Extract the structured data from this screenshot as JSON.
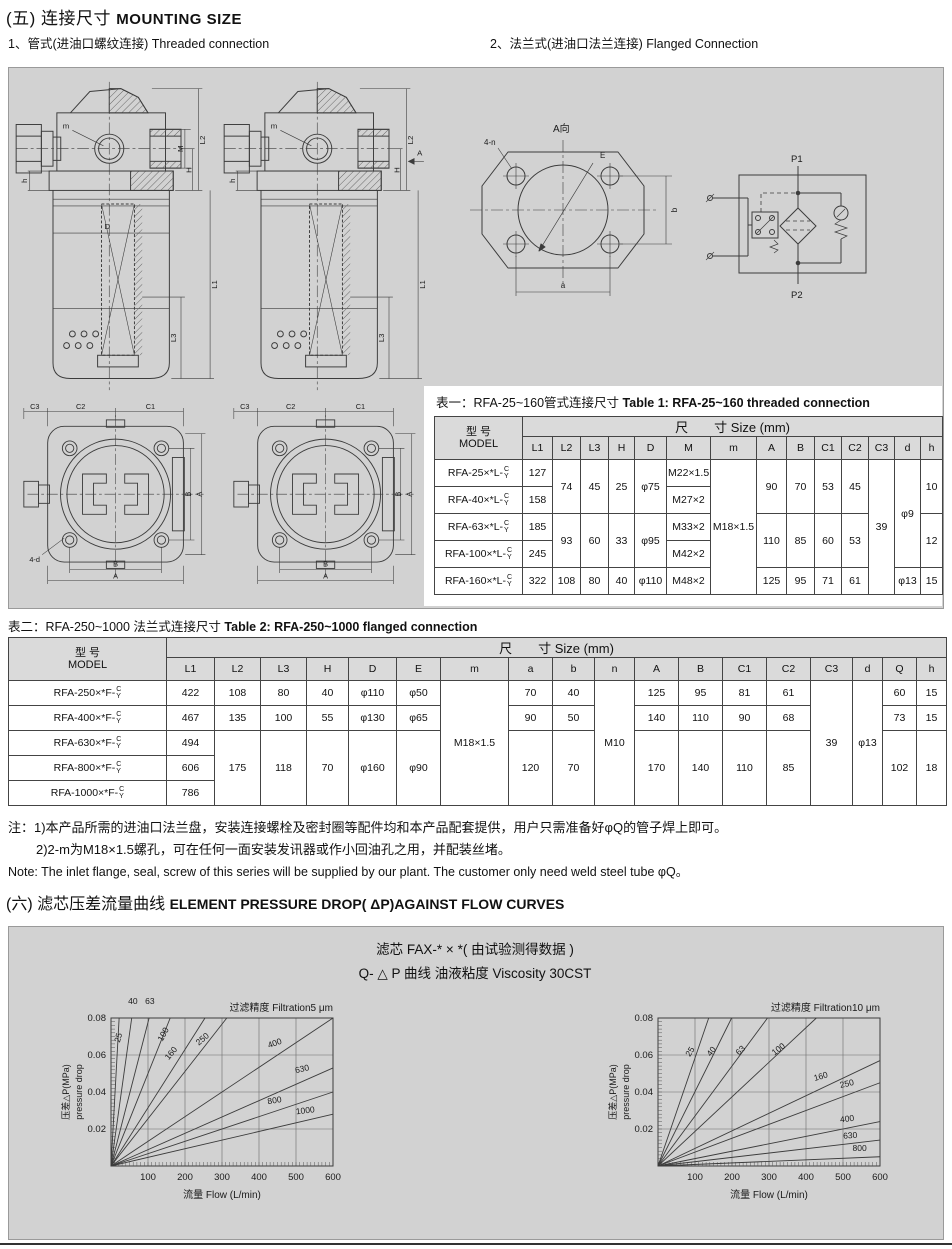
{
  "colors": {
    "panel_bg": "#d2d2d2",
    "line": "#3c3c3c",
    "table_header_bg": "#dadada",
    "text": "#111111"
  },
  "section5": {
    "title_zh": "(五) 连接尺寸",
    "title_en": "MOUNTING SIZE",
    "sub1_zh": "1、管式(进油口螺纹连接)",
    "sub1_en": "Threaded connection",
    "sub2_zh": "2、法兰式(进油口法兰连接)",
    "sub2_en": "Flanged Connection"
  },
  "drawings": {
    "filter1": {
      "m": "m",
      "h": "h",
      "D": "D",
      "M": "M",
      "H": "H",
      "L1": "L1",
      "L2": "L2",
      "L3": "L3"
    },
    "filter2": {
      "m": "m",
      "h": "h",
      "H": "H",
      "L1": "L1",
      "L2": "L2",
      "L3": "L3",
      "A": "A"
    },
    "flange": {
      "view": "A向",
      "bolt": "4-n",
      "E": "E",
      "a": "a",
      "b": "b"
    },
    "topview1": {
      "C1": "C1",
      "C2": "C2",
      "C3": "C3",
      "A": "A",
      "B": "B",
      "A2": "A",
      "B2": "B",
      "bolt": "4-d"
    },
    "topview2": {
      "C1": "C1",
      "C2": "C2",
      "C3": "C3",
      "A": "A",
      "B": "B",
      "A2": "A",
      "B2": "B"
    },
    "symbol": {
      "p1": "P1",
      "p2": "P2"
    }
  },
  "table1": {
    "title_zh": "表一：RFA-25~160管式连接尺寸",
    "title_en": "Table 1: RFA-25~160 threaded connection",
    "model_zh": "型  号",
    "model_en": "MODEL",
    "size_header": "尺　　寸  Size  (mm)",
    "stack": [
      "C",
      "Y"
    ],
    "columns": [
      "L1",
      "L2",
      "L3",
      "H",
      "D",
      "M",
      "m",
      "A",
      "B",
      "C1",
      "C2",
      "C3",
      "d",
      "h"
    ],
    "grid": [
      [
        {
          "m": "RFA-25×*L-"
        },
        {
          "t": "127"
        },
        {
          "t": "74",
          "rs": 2
        },
        {
          "t": "45",
          "rs": 2
        },
        {
          "t": "25",
          "rs": 2
        },
        {
          "t": "φ75",
          "rs": 2
        },
        {
          "t": "M22×1.5"
        },
        {
          "t": "M18×1.5",
          "rs": 5
        },
        {
          "t": "90",
          "rs": 2
        },
        {
          "t": "70",
          "rs": 2
        },
        {
          "t": "53",
          "rs": 2
        },
        {
          "t": "45",
          "rs": 2
        },
        {
          "t": "39",
          "rs": 5
        },
        {
          "t": "φ9",
          "rs": 4
        },
        {
          "t": "10",
          "rs": 2
        }
      ],
      [
        {
          "m": "RFA-40×*L-"
        },
        {
          "t": "158"
        },
        {
          "t": "M27×2"
        }
      ],
      [
        {
          "m": "RFA-63×*L-"
        },
        {
          "t": "185"
        },
        {
          "t": "93",
          "rs": 2
        },
        {
          "t": "60",
          "rs": 2
        },
        {
          "t": "33",
          "rs": 2
        },
        {
          "t": "φ95",
          "rs": 2
        },
        {
          "t": "M33×2"
        },
        {
          "t": "110",
          "rs": 2
        },
        {
          "t": "85",
          "rs": 2
        },
        {
          "t": "60",
          "rs": 2
        },
        {
          "t": "53",
          "rs": 2
        },
        {
          "t": "12",
          "rs": 2
        }
      ],
      [
        {
          "m": "RFA-100×*L-"
        },
        {
          "t": "245"
        },
        {
          "t": "M42×2"
        }
      ],
      [
        {
          "m": "RFA-160×*L-"
        },
        {
          "t": "322"
        },
        {
          "t": "108"
        },
        {
          "t": "80"
        },
        {
          "t": "40"
        },
        {
          "t": "φ110"
        },
        {
          "t": "M48×2"
        },
        {
          "t": "125"
        },
        {
          "t": "95"
        },
        {
          "t": "71"
        },
        {
          "t": "61"
        },
        {
          "t": "φ13"
        },
        {
          "t": "15"
        }
      ]
    ]
  },
  "table2": {
    "title_zh": "表二：RFA-250~1000 法兰式连接尺寸",
    "title_en": "Table 2: RFA-250~1000 flanged  connection",
    "model_zh": "型  号",
    "model_en": "MODEL",
    "size_header": "尺　　寸  Size  (mm)",
    "stack": [
      "C",
      "Y"
    ],
    "columns": [
      "L1",
      "L2",
      "L3",
      "H",
      "D",
      "E",
      "m",
      "a",
      "b",
      "n",
      "A",
      "B",
      "C1",
      "C2",
      "C3",
      "d",
      "Q",
      "h"
    ],
    "grid": [
      [
        {
          "m": "RFA-250×*F-"
        },
        {
          "t": "422"
        },
        {
          "t": "108"
        },
        {
          "t": "80"
        },
        {
          "t": "40"
        },
        {
          "t": "φ110"
        },
        {
          "t": "φ50"
        },
        {
          "t": "M18×1.5",
          "rs": 5
        },
        {
          "t": "70"
        },
        {
          "t": "40"
        },
        {
          "t": "M10",
          "rs": 5
        },
        {
          "t": "125"
        },
        {
          "t": "95"
        },
        {
          "t": "81"
        },
        {
          "t": "61"
        },
        {
          "t": "39",
          "rs": 5
        },
        {
          "t": "φ13",
          "rs": 5
        },
        {
          "t": "60"
        },
        {
          "t": "15"
        }
      ],
      [
        {
          "m": "RFA-400×*F-"
        },
        {
          "t": "467"
        },
        {
          "t": "135"
        },
        {
          "t": "100"
        },
        {
          "t": "55"
        },
        {
          "t": "φ130"
        },
        {
          "t": "φ65"
        },
        {
          "t": "90"
        },
        {
          "t": "50"
        },
        {
          "t": "140"
        },
        {
          "t": "110"
        },
        {
          "t": "90"
        },
        {
          "t": "68"
        },
        {
          "t": "73"
        },
        {
          "t": "15"
        }
      ],
      [
        {
          "m": "RFA-630×*F-"
        },
        {
          "t": "494"
        },
        {
          "t": "175",
          "rs": 3
        },
        {
          "t": "118",
          "rs": 3
        },
        {
          "t": "70",
          "rs": 3
        },
        {
          "t": "φ160",
          "rs": 3
        },
        {
          "t": "φ90",
          "rs": 3
        },
        {
          "t": "120",
          "rs": 3
        },
        {
          "t": "70",
          "rs": 3
        },
        {
          "t": "170",
          "rs": 3
        },
        {
          "t": "140",
          "rs": 3
        },
        {
          "t": "110",
          "rs": 3
        },
        {
          "t": "85",
          "rs": 3
        },
        {
          "t": "102",
          "rs": 3
        },
        {
          "t": "18",
          "rs": 3
        }
      ],
      [
        {
          "m": "RFA-800×*F-"
        },
        {
          "t": "606"
        }
      ],
      [
        {
          "m": "RFA-1000×*F-"
        },
        {
          "t": "786"
        }
      ]
    ]
  },
  "notes": {
    "line1": "注：1)本产品所需的进油口法兰盘，安装连接螺栓及密封圈等配件均和本产品配套提供，用户只需准备好φQ的管子焊上即可。",
    "line2": "2)2-m为M18×1.5螺孔，可在任何一面安装发讯器或作小回油孔之用，并配装丝堵。",
    "line3": "Note: The inlet flange, seal, screw of this series will be supplied by our plant. The customer only need weld steel tube φQ。"
  },
  "section6": {
    "title_zh": "(六) 滤芯压差流量曲线",
    "title_en": "ELEMENT PRESSURE DROP( ΔP)AGAINST FLOW CURVES",
    "box_line1": "滤芯 FAX-* × *( 由试验测得数据 )",
    "box_line2": "Q- △ P 曲线 油液粘度 Viscosity 30CST"
  },
  "chart_data": [
    {
      "type": "line",
      "caption": "过滤精度  Filtration5 μm",
      "ylabel_zh": "压差△P(MPa)",
      "ylabel_en": "pressure drop",
      "xlabel": "流量 Flow   (L/min)",
      "xlim": [
        0,
        600
      ],
      "ylim": [
        0,
        0.08
      ],
      "x_ticks": [
        100,
        200,
        300,
        400,
        500,
        600
      ],
      "y_ticks": [
        0.02,
        0.04,
        0.06,
        0.08
      ],
      "grid": true,
      "legend": "labels-on-lines",
      "series": [
        {
          "name": "25",
          "end": [
            22,
            0.08
          ],
          "label": [
            27,
            0.069
          ],
          "rot": -75
        },
        {
          "name": "40",
          "end": [
            56,
            0.08
          ],
          "label": [
            59,
            0.0875
          ],
          "rot": 0
        },
        {
          "name": "63",
          "end": [
            103,
            0.08
          ],
          "label": [
            105,
            0.0875
          ],
          "rot": 0
        },
        {
          "name": "100",
          "end": [
            160,
            0.08
          ],
          "label": [
            148,
            0.0705
          ],
          "rot": -62
        },
        {
          "name": "160",
          "end": [
            254,
            0.08
          ],
          "label": [
            168,
            0.06
          ],
          "rot": -50
        },
        {
          "name": "250",
          "end": [
            313,
            0.08
          ],
          "label": [
            252,
            0.0675
          ],
          "rot": -40
        },
        {
          "name": "400",
          "end": [
            600,
            0.08
          ],
          "label": [
            445,
            0.065
          ],
          "rot": -20
        },
        {
          "name": "630",
          "end": [
            600,
            0.053
          ],
          "label": [
            518,
            0.051
          ],
          "rot": -13
        },
        {
          "name": "800",
          "end": [
            600,
            0.04
          ],
          "label": [
            443,
            0.034
          ],
          "rot": -9
        },
        {
          "name": "1000",
          "end": [
            600,
            0.028
          ],
          "label": [
            526,
            0.0285
          ],
          "rot": -7
        }
      ]
    },
    {
      "type": "line",
      "caption": "过滤精度  Filtration10 μm",
      "ylabel_zh": "压差△P(MPa)",
      "ylabel_en": "pressure drop",
      "xlabel": "流量 Flow   (L/min)",
      "xlim": [
        0,
        600
      ],
      "ylim": [
        0,
        0.08
      ],
      "x_ticks": [
        100,
        200,
        300,
        400,
        500,
        600
      ],
      "y_ticks": [
        0.02,
        0.04,
        0.06,
        0.08
      ],
      "grid": true,
      "legend": "labels-on-lines",
      "series": [
        {
          "name": "25",
          "end": [
            137,
            0.08
          ],
          "label": [
            93,
            0.061
          ],
          "rot": -58
        },
        {
          "name": "40",
          "end": [
            199,
            0.08
          ],
          "label": [
            150,
            0.061
          ],
          "rot": -52
        },
        {
          "name": "63",
          "end": [
            296,
            0.08
          ],
          "label": [
            228,
            0.0615
          ],
          "rot": -45
        },
        {
          "name": "100",
          "end": [
            428,
            0.08
          ],
          "label": [
            330,
            0.062
          ],
          "rot": -38
        },
        {
          "name": "160",
          "end": [
            600,
            0.057
          ],
          "label": [
            442,
            0.047
          ],
          "rot": -16
        },
        {
          "name": "250",
          "end": [
            600,
            0.045
          ],
          "label": [
            512,
            0.043
          ],
          "rot": -13
        },
        {
          "name": "400",
          "end": [
            600,
            0.024
          ],
          "label": [
            512,
            0.024
          ],
          "rot": -7
        },
        {
          "name": "630",
          "end": [
            600,
            0.014
          ],
          "label": [
            520,
            0.015
          ],
          "rot": -4
        },
        {
          "name": "800",
          "end": [
            600,
            0.005
          ],
          "label": [
            545,
            0.008
          ],
          "rot": 0
        }
      ]
    }
  ]
}
